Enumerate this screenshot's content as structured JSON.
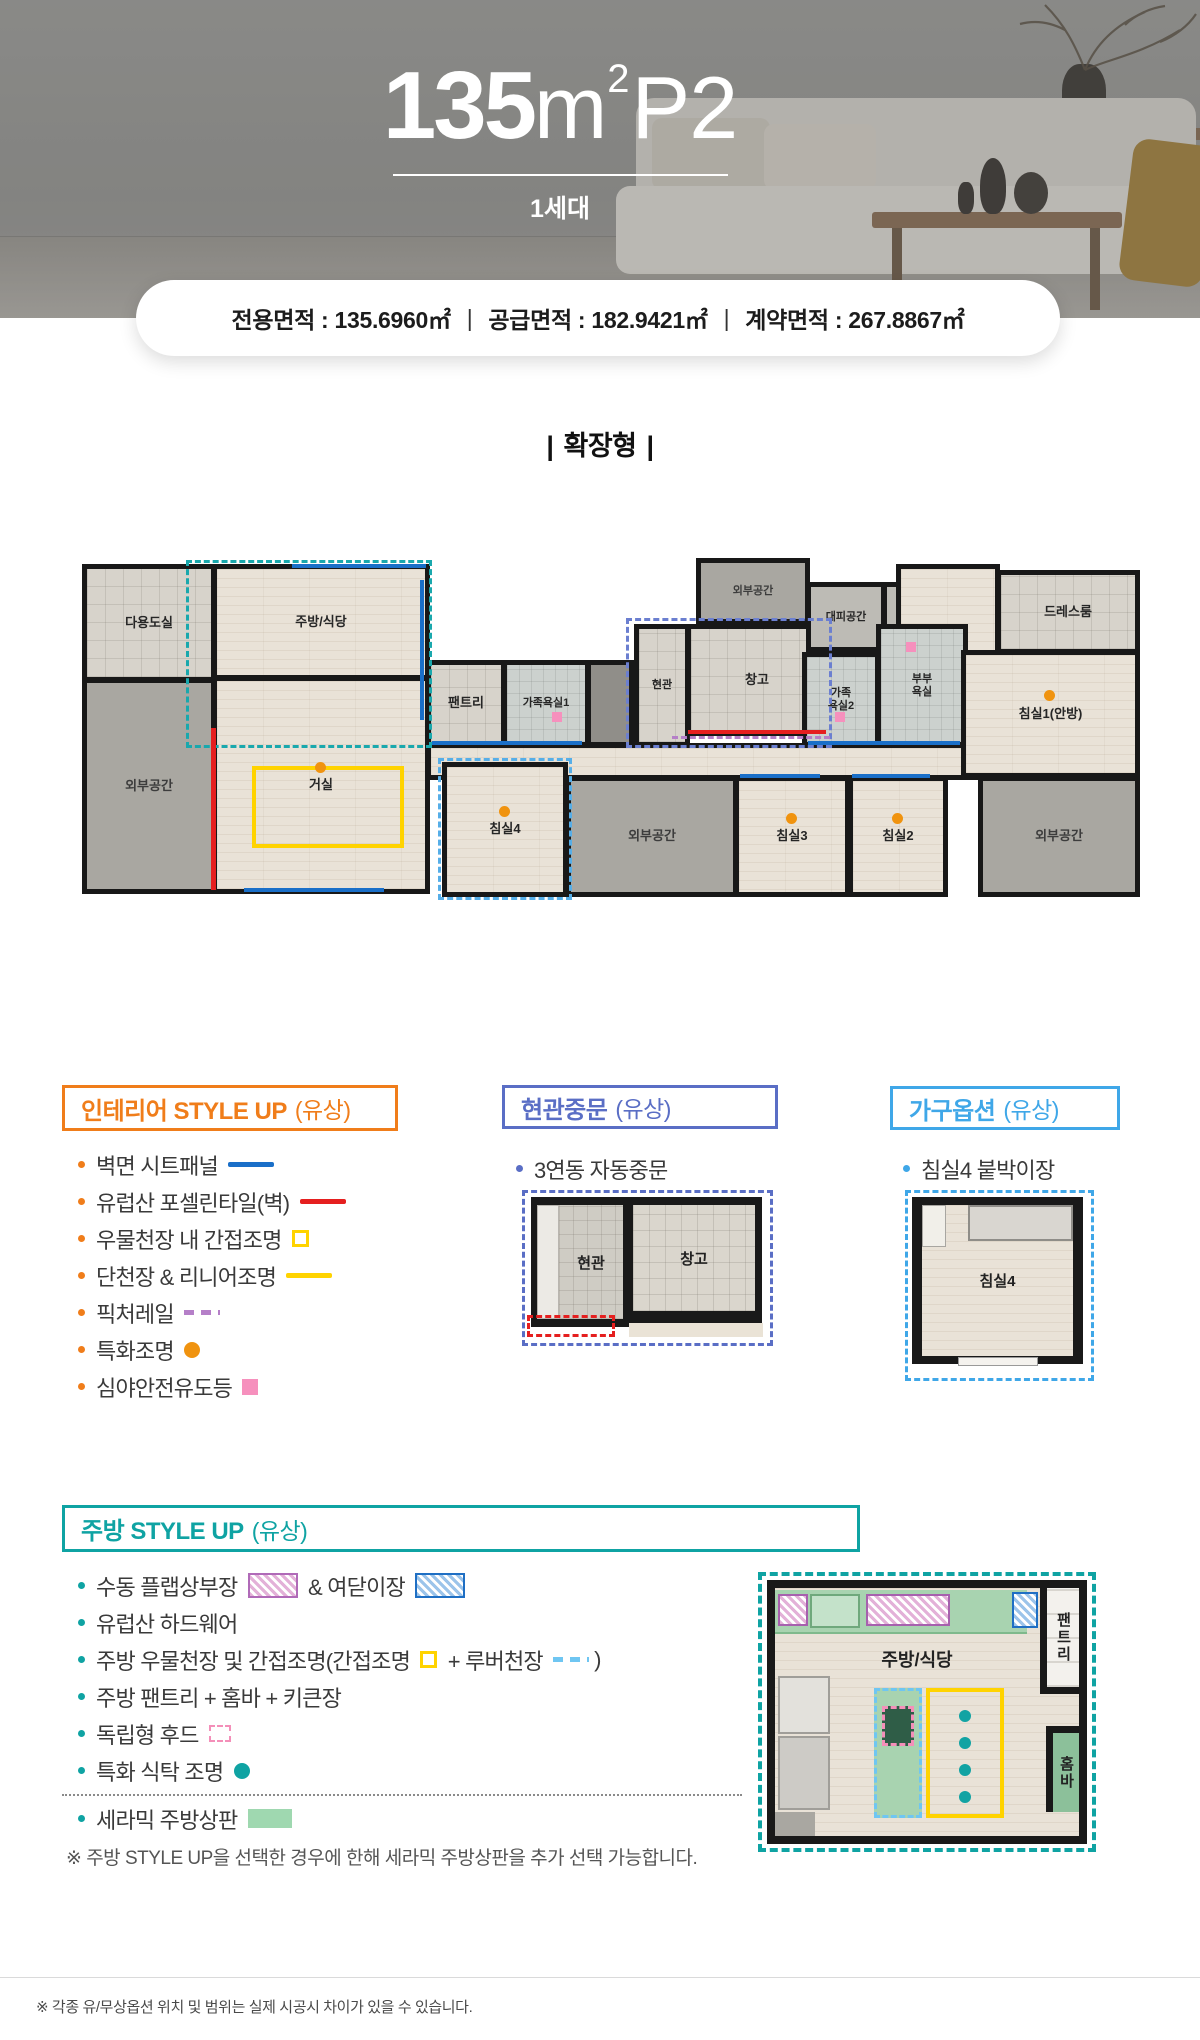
{
  "header": {
    "title_num": "135",
    "title_unit": "m",
    "title_sup": "2",
    "title_suffix": "P2",
    "subtitle": "1세대",
    "area_separator": "|",
    "areas": [
      {
        "label": "전용면적",
        "value": "135.6960㎡"
      },
      {
        "label": "공급면적",
        "value": "182.9421㎡"
      },
      {
        "label": "계약면적",
        "value": "267.8867㎡"
      }
    ]
  },
  "plan_heading": {
    "bar": "|",
    "text": "확장형"
  },
  "colors": {
    "interior_accent": "#f07d1a",
    "door_accent": "#5a6ec5",
    "furniture_accent": "#3fa7e8",
    "kitchen_accent": "#0fa3a3",
    "sheet_panel_blue": "#1a6fc8",
    "porcelain_red": "#e51f1f",
    "ceiling_yellow": "#ffd300",
    "picture_rail_purple": "#b57fc8",
    "special_light_orange": "#f0930f",
    "night_light_pink": "#f690bd",
    "louver_lightblue": "#6fc6f2",
    "ceramic_green": "#9fd8b0"
  },
  "floorplan": {
    "rooms": [
      {
        "name": "room-corridor",
        "label": "",
        "type": "wood",
        "rect": [
          368,
          185,
          560,
          33
        ]
      },
      {
        "name": "room-utility",
        "label": "다용도실",
        "type": "tile",
        "rect": [
          24,
          6,
          130,
          114
        ]
      },
      {
        "name": "room-ext-left",
        "label": "외부공간",
        "type": "ext",
        "rect": [
          24,
          120,
          130,
          212
        ]
      },
      {
        "name": "room-kitchen",
        "label": "주방/식당",
        "type": "wood",
        "rect": [
          154,
          6,
          214,
          112
        ]
      },
      {
        "name": "room-living",
        "label": "거실",
        "type": "wood",
        "rect": [
          154,
          118,
          214,
          214
        ]
      },
      {
        "name": "room-pantry",
        "label": "팬트리",
        "type": "tile",
        "rect": [
          368,
          102,
          76,
          83
        ]
      },
      {
        "name": "room-familybath1",
        "label": "가족욕실1",
        "type": "bath",
        "rect": [
          444,
          102,
          84,
          83
        ],
        "small": true
      },
      {
        "name": "room-duct",
        "label": "",
        "type": "duct",
        "rect": [
          528,
          102,
          44,
          83
        ]
      },
      {
        "name": "room-entry",
        "label": "현관",
        "type": "tile",
        "rect": [
          576,
          66,
          52,
          119
        ],
        "small": true
      },
      {
        "name": "room-storage",
        "label": "창고",
        "type": "tile",
        "rect": [
          628,
          66,
          138,
          108
        ]
      },
      {
        "name": "room-ext-top",
        "label": "외부공간",
        "type": "ext",
        "rect": [
          638,
          0,
          110,
          62
        ],
        "small": true
      },
      {
        "name": "room-shelter",
        "label": "대피공간",
        "type": "extl",
        "rect": [
          748,
          24,
          76,
          66
        ],
        "small": true
      },
      {
        "name": "room-ac-outdoor",
        "label": "실외기실",
        "type": "extl",
        "rect": [
          824,
          24,
          66,
          66
        ],
        "small": true
      },
      {
        "name": "room-anbang-hall",
        "label": "",
        "type": "wood",
        "rect": [
          838,
          6,
          100,
          88
        ]
      },
      {
        "name": "room-masterbath",
        "label": "부부\n욕실",
        "type": "bath",
        "rect": [
          818,
          66,
          88,
          119
        ],
        "small": true
      },
      {
        "name": "room-familybath2",
        "label": "가족\n욕실2",
        "type": "bath",
        "rect": [
          744,
          94,
          74,
          91
        ],
        "small": true
      },
      {
        "name": "room-dressroom",
        "label": "드레스룸",
        "type": "tile",
        "rect": [
          938,
          12,
          140,
          80
        ]
      },
      {
        "name": "room-bedroom1",
        "label": "침실1(안방)",
        "type": "wood",
        "rect": [
          903,
          92,
          175,
          124
        ]
      },
      {
        "name": "room-bedroom4",
        "label": "침실4",
        "type": "wood",
        "rect": [
          384,
          204,
          122,
          131
        ]
      },
      {
        "name": "room-ext-bottom-mid",
        "label": "외부공간",
        "type": "ext",
        "rect": [
          508,
          218,
          168,
          117
        ]
      },
      {
        "name": "room-bedroom3",
        "label": "침실3",
        "type": "wood",
        "rect": [
          676,
          218,
          112,
          117
        ]
      },
      {
        "name": "room-bedroom2",
        "label": "침실2",
        "type": "wood",
        "rect": [
          790,
          218,
          96,
          117
        ]
      },
      {
        "name": "room-ext-bottom-right",
        "label": "외부공간",
        "type": "ext",
        "rect": [
          920,
          218,
          158,
          117
        ]
      }
    ],
    "overlays": [
      {
        "name": "zone-kitchen-teal-dashed",
        "type": "dash-rect",
        "color": "#19a8ad",
        "rect": [
          126,
          0,
          246,
          188
        ]
      },
      {
        "name": "zone-entry-blue-dashed",
        "type": "dash-rect",
        "color": "#6b7fd0",
        "rect": [
          566,
          58,
          206,
          130
        ]
      },
      {
        "name": "zone-bedroom4-dashed",
        "type": "dash-rect",
        "color": "#56aee8",
        "rect": [
          378,
          198,
          134,
          142
        ]
      },
      {
        "name": "living-ceiling-yellow",
        "type": "rect-outline",
        "color": "#ffd300",
        "rect": [
          192,
          206,
          152,
          82
        ]
      },
      {
        "name": "sheet-panel-line1",
        "type": "hline",
        "color": "#1a6fc8",
        "rect": [
          232,
          4,
          134,
          4
        ]
      },
      {
        "name": "sheet-panel-line2",
        "type": "vline",
        "color": "#1a6fc8",
        "rect": [
          360,
          20,
          4,
          140
        ]
      },
      {
        "name": "sheet-panel-line3",
        "type": "hline",
        "color": "#1a6fc8",
        "rect": [
          184,
          328,
          140,
          4
        ]
      },
      {
        "name": "sheet-panel-line4",
        "type": "hline",
        "color": "#1a6fc8",
        "rect": [
          372,
          181,
          150,
          4
        ]
      },
      {
        "name": "sheet-panel-line5",
        "type": "hline",
        "color": "#1a6fc8",
        "rect": [
          748,
          181,
          152,
          4
        ]
      },
      {
        "name": "sheet-panel-line6",
        "type": "hline",
        "color": "#1a6fc8",
        "rect": [
          680,
          214,
          80,
          4
        ]
      },
      {
        "name": "sheet-panel-line7",
        "type": "hline",
        "color": "#1a6fc8",
        "rect": [
          792,
          214,
          78,
          4
        ]
      },
      {
        "name": "porcelain-tile-line1",
        "type": "vline",
        "color": "#e51f1f",
        "rect": [
          151,
          168,
          5,
          162
        ]
      },
      {
        "name": "porcelain-tile-line2",
        "type": "hline",
        "color": "#e51f1f",
        "rect": [
          628,
          170,
          138,
          4
        ]
      },
      {
        "name": "picture-rail-dash",
        "type": "dash-hline",
        "color": "#b57fc8",
        "rect": [
          612,
          176,
          158,
          3
        ]
      },
      {
        "name": "night-light-bath1",
        "type": "mark",
        "color": "#f690bd",
        "rect": [
          492,
          152,
          10,
          10
        ]
      },
      {
        "name": "night-light-bath2",
        "type": "mark",
        "color": "#f690bd",
        "rect": [
          775,
          152,
          10,
          10
        ]
      },
      {
        "name": "night-light-masterbath",
        "type": "mark",
        "color": "#f690bd",
        "rect": [
          846,
          82,
          10,
          10
        ]
      },
      {
        "name": "special-light-living",
        "type": "dot",
        "color": "#f0930f",
        "rect": [
          255,
          202,
          11,
          11
        ]
      },
      {
        "name": "special-light-bedroom4",
        "type": "dot",
        "color": "#f0930f",
        "rect": [
          439,
          246,
          11,
          11
        ]
      },
      {
        "name": "special-light-bedroom3",
        "type": "dot",
        "color": "#f0930f",
        "rect": [
          726,
          253,
          11,
          11
        ]
      },
      {
        "name": "special-light-bedroom2",
        "type": "dot",
        "color": "#f0930f",
        "rect": [
          832,
          253,
          11,
          11
        ]
      },
      {
        "name": "special-light-bedroom1",
        "type": "dot",
        "color": "#f0930f",
        "rect": [
          984,
          130,
          11,
          11
        ]
      }
    ]
  },
  "sections": {
    "interior": {
      "title": "인테리어 STYLE UP",
      "title_paren": "(유상)",
      "accent": "#f07d1a",
      "items": [
        [
          {
            "t": "벽면 시트패널 "
          },
          {
            "s": "line",
            "c": "#1a6fc8"
          }
        ],
        [
          {
            "t": "유럽산 포셀린타일(벽) "
          },
          {
            "s": "line",
            "c": "#e51f1f"
          }
        ],
        [
          {
            "t": "우물천장 내 간접조명 "
          },
          {
            "s": "sq-outline",
            "c": "#ffd300"
          }
        ],
        [
          {
            "t": "단천장 & 리니어조명 "
          },
          {
            "s": "line",
            "c": "#ffd300"
          }
        ],
        [
          {
            "t": "픽처레일 "
          },
          {
            "s": "dashes",
            "c": "#b57fc8"
          }
        ],
        [
          {
            "t": "특화조명 "
          },
          {
            "s": "circle",
            "c": "#f0930f"
          }
        ],
        [
          {
            "t": "심야안전유도등 "
          },
          {
            "s": "square",
            "c": "#f690bd"
          }
        ]
      ]
    },
    "door": {
      "title": "현관중문",
      "title_paren": "(유상)",
      "accent": "#5a6ec5",
      "items": [
        [
          {
            "t": "3연동 자동중문"
          }
        ]
      ],
      "miniplan": {
        "entry": "현관",
        "storage": "창고"
      }
    },
    "furniture": {
      "title": "가구옵션",
      "title_paren": "(유상)",
      "accent": "#3fa7e8",
      "items": [
        [
          {
            "t": "침실4 붙박이장"
          }
        ]
      ],
      "miniplan": {
        "room": "침실4"
      }
    },
    "kitchen": {
      "title": "주방 STYLE UP",
      "title_paren": "(유상)",
      "accent": "#0fa3a3",
      "items": [
        [
          {
            "t": "수동 플랩상부장 "
          },
          {
            "s": "hatch",
            "c": "#b06ab8",
            "c2": "#e3b1d8"
          },
          {
            "t": " & 여닫이장 "
          },
          {
            "s": "hatch",
            "c": "#1f6fc4",
            "c2": "#9cc4ea"
          }
        ],
        [
          {
            "t": "유럽산 하드웨어"
          }
        ],
        [
          {
            "t": "주방 우물천장 및 간접조명(간접조명 "
          },
          {
            "s": "sq-outline",
            "c": "#ffd300"
          },
          {
            "t": " + 루버천장 "
          },
          {
            "s": "dashes",
            "c": "#6fc6f2"
          },
          {
            "t": ")"
          }
        ],
        [
          {
            "t": "주방 팬트리 + 홈바 + 키큰장"
          }
        ],
        [
          {
            "t": "독립형 후드 "
          },
          {
            "s": "dash-square",
            "c": "#f48fb9"
          }
        ],
        [
          {
            "t": "특화 식탁 조명 "
          },
          {
            "s": "circle",
            "c": "#0fa3a3"
          }
        ]
      ],
      "ceramic_items": [
        [
          {
            "t": "세라믹 주방상판 "
          },
          {
            "s": "rect",
            "c": "#9fd8b0"
          }
        ]
      ],
      "note": "※ 주방 STYLE UP을 선택한 경우에 한해 세라믹 주방상판을 추가 선택 가능합니다.",
      "miniplan": {
        "kitchen": "주방/식당",
        "pantry": "팬트리",
        "homebar": "홈바"
      }
    }
  },
  "footer": {
    "note": "※ 각종 유/무상옵션 위치 및 범위는 실제 시공시 차이가 있을 수 있습니다."
  }
}
